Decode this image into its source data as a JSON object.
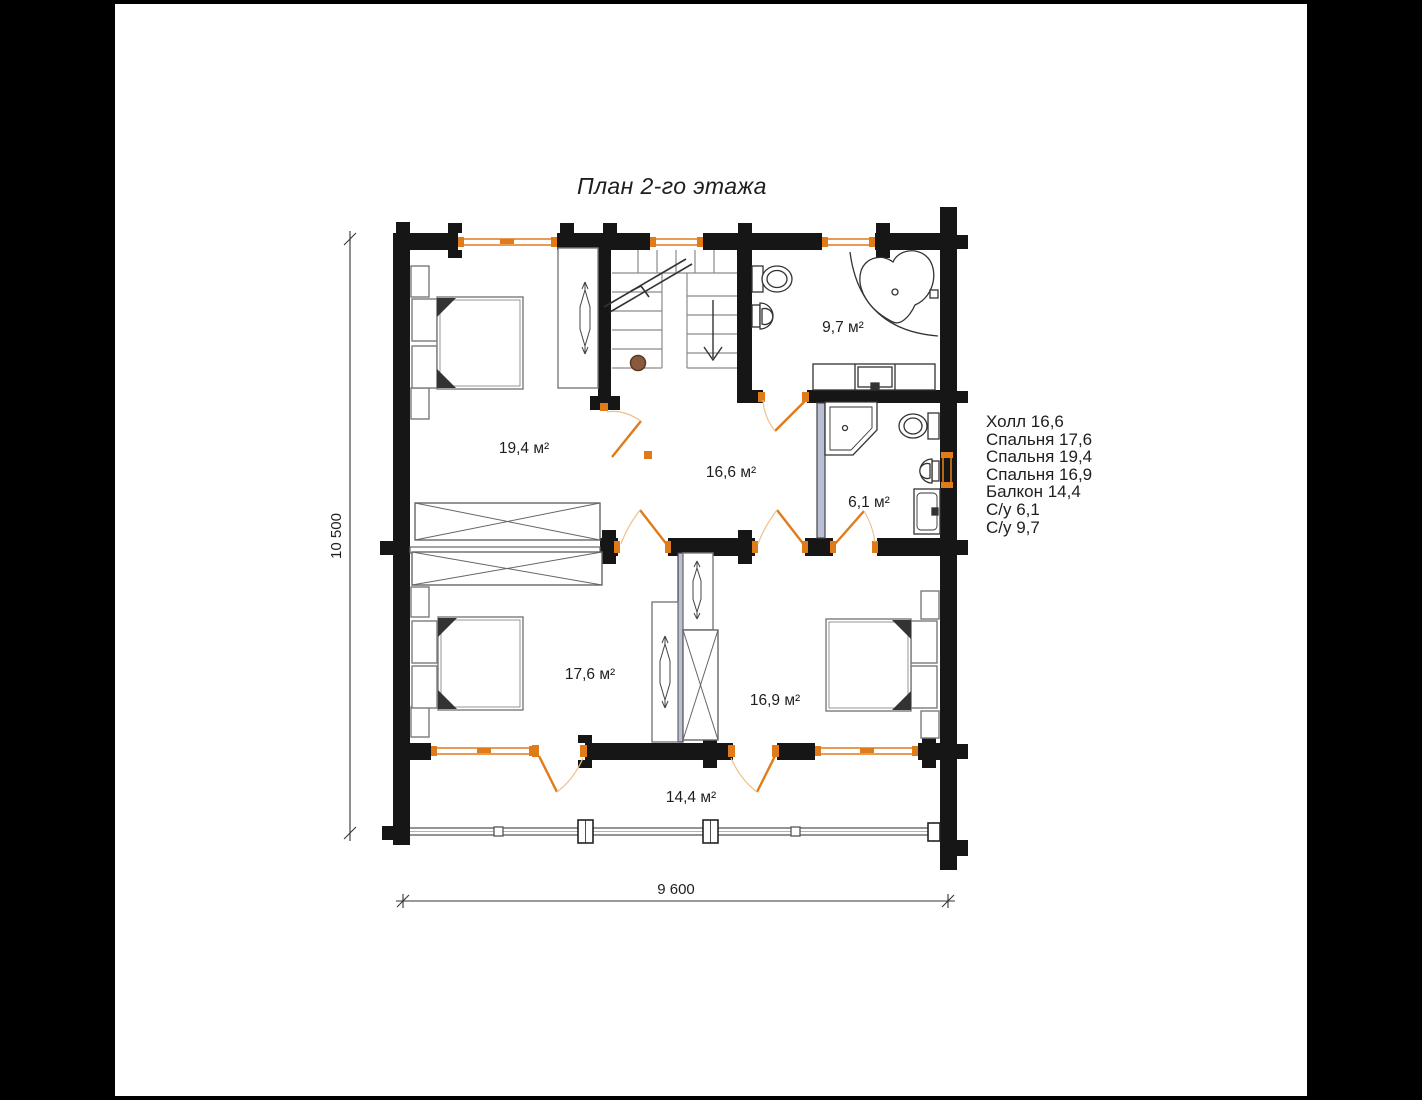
{
  "title": "План 2-го этажа",
  "legend": {
    "items": [
      "Холл 16,6",
      "Спальня 17,6",
      "Спальня 19,4",
      "Спальня 16,9",
      "Балкон 14,4",
      "С/у 6,1",
      "С/у 9,7"
    ]
  },
  "rooms": {
    "bedroom_194": {
      "area_label": "19,4 м²"
    },
    "hall": {
      "area_label": "16,6 м²"
    },
    "bathroom_97": {
      "area_label": "9,7 м²"
    },
    "bathroom_61": {
      "area_label": "6,1 м²"
    },
    "bedroom_176": {
      "area_label": "17,6 м²"
    },
    "bedroom_169": {
      "area_label": "16,9 м²"
    },
    "balcony": {
      "area_label": "14,4 м²"
    }
  },
  "dimensions": {
    "horizontal": "9 600",
    "vertical": "10 500"
  },
  "colors": {
    "wall": "#161616",
    "window_door_orange": "#e07b1a",
    "door_arc_light": "#eec08e",
    "furniture_gray": "#7a7a7a",
    "stair_gray": "#8a8a8a",
    "fixture_dark": "#333333",
    "newel_brown": "#8a5a3f",
    "partition_blue": "#b9c0d6"
  }
}
